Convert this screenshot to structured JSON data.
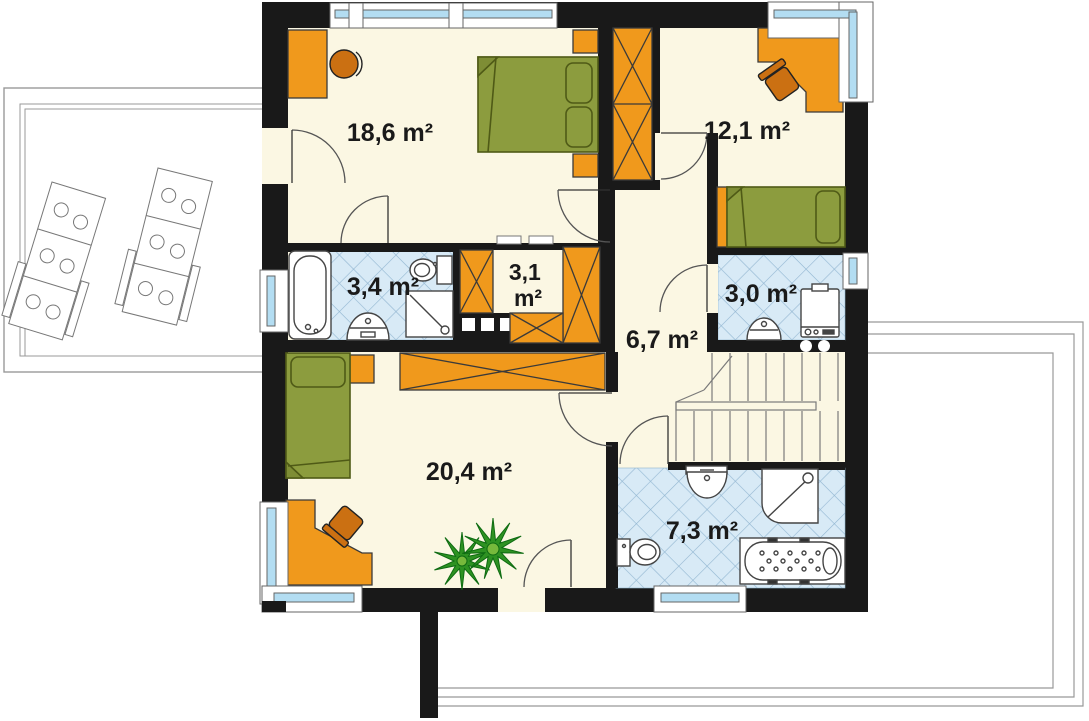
{
  "plan": {
    "title": "upper-floor-plan",
    "rooms": [
      {
        "name": "bedroom-top-left",
        "label": "18,6 m²",
        "area_m2": 18.6
      },
      {
        "name": "bedroom-top-right",
        "label": "12,1 m²",
        "area_m2": 12.1
      },
      {
        "name": "bathroom-left",
        "label": "3,4 m²",
        "area_m2": 3.4
      },
      {
        "name": "wardrobe-closet",
        "value": "3,1",
        "unit": "m²",
        "area_m2": 3.1
      },
      {
        "name": "bathroom-right",
        "label": "3,0 m²",
        "area_m2": 3.0
      },
      {
        "name": "hall",
        "label": "6,7 m²",
        "area_m2": 6.7
      },
      {
        "name": "bedroom-bottom",
        "label": "20,4 m²",
        "area_m2": 20.4
      },
      {
        "name": "bathroom-bottom",
        "label": "7,3 m²",
        "area_m2": 7.3
      }
    ],
    "colors": {
      "wall": "#191919",
      "floor": "#FBF7E3",
      "furniture_orange": "#F0991C",
      "chair_orange": "#CB7012",
      "bed_green": "#8C9C3E",
      "tile_blue": "#D8EAF6",
      "glazing_blue": "#B3DDF2",
      "terrace_line": "#999999"
    }
  }
}
